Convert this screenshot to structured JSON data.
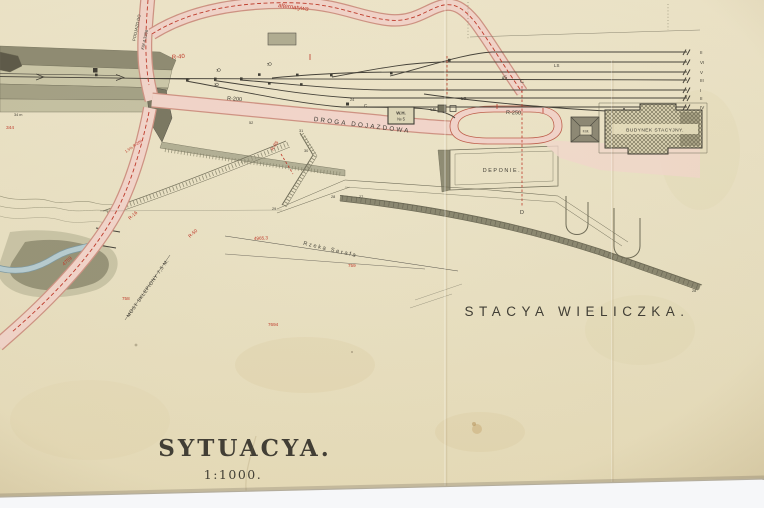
{
  "photo": {
    "background": "#f6f7f9",
    "paper_color": "#e9e1c4"
  },
  "colors": {
    "annotation_red": "#bf3a2b",
    "ink": "#3f3d35",
    "road_pink": "#f2d5cb",
    "river_blue": "#b7cdd2",
    "terrain_olive": "#a5a287"
  },
  "plan": {
    "title": "SYTUACYA.",
    "scale": "1:1000.",
    "station_name": "STACYA WIELICZKA.",
    "road_label": "DROGA DOJAZDOWA",
    "station_building": "BUDYNEK STACYJNY.",
    "deponie": "DEPONIE.",
    "weigh_house_line1": "W.H.",
    "weigh_house_line2": "№ 5",
    "lb": "LB",
    "fm": "F.M.",
    "river_label": "Rzeka Serafa",
    "bridge_label": "MOST SKLEPIONY 7,5 M.",
    "approach_line1": "PODJAZD DO",
    "approach_line2": "KM 4.3206",
    "alt_route": "alternatywa",
    "r40": "R-40",
    "r200": "R-200",
    "r250": "R-250",
    "r85": "R-85",
    "r50": "R-50",
    "r16": "R-16",
    "grade": "1.5% R-200",
    "c_mark": "C",
    "c_mark2": "C",
    "d_mark": "D",
    "ls1": "LS",
    "ls2": "LS",
    "angle45": "45",
    "track_numbers": [
      "II",
      "VI",
      "V",
      "III",
      "I",
      "II",
      "IV"
    ],
    "switch_numbers": [
      "1",
      "3",
      "5"
    ],
    "elevations": [
      "344",
      "4759",
      "758",
      "759",
      "4965,3",
      "7694"
    ],
    "points": [
      "24",
      "27",
      "28",
      "29",
      "30",
      "31",
      "52",
      "28",
      "34 m"
    ]
  }
}
